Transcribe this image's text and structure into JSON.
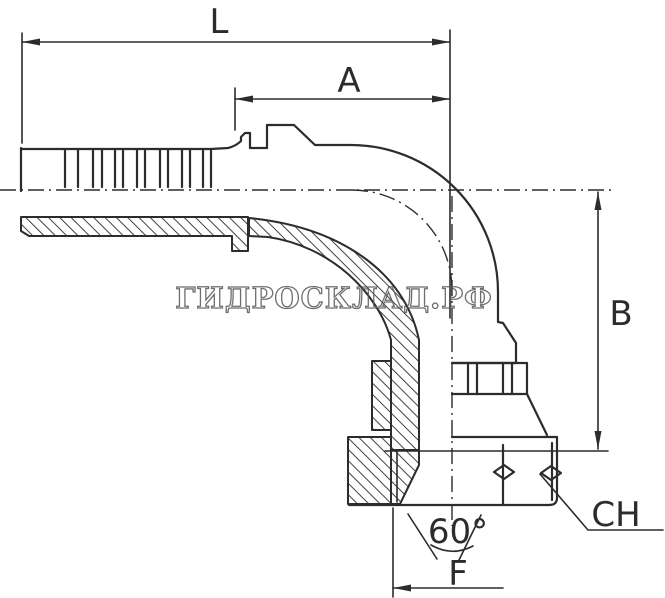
{
  "labels": {
    "overall_length": "L",
    "tail_length": "A",
    "height": "B",
    "wrench": "CH",
    "seat": "F",
    "cone_angle": "60°"
  },
  "watermark": {
    "text": "ГИДРОСКЛАД.РФ"
  },
  "colors": {
    "line": "#2c2c2e",
    "background": "#ffffff",
    "watermark_outline": "#55555a"
  }
}
